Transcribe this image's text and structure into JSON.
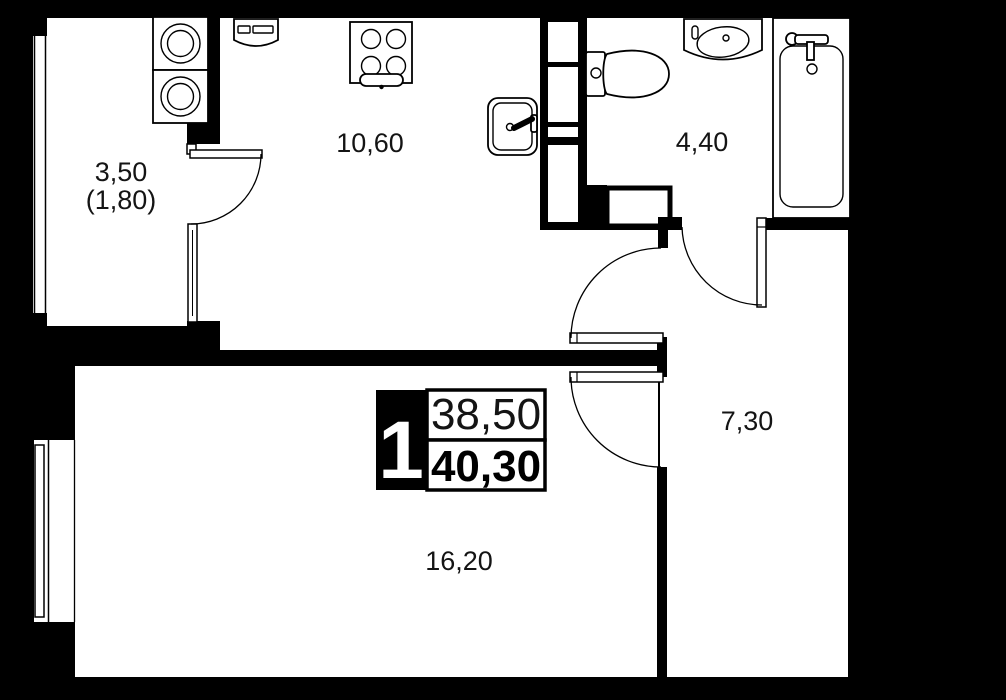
{
  "plan": {
    "unit_badge": {
      "rooms_count": "1",
      "living_area": "38,50",
      "total_area": "40,30"
    },
    "rooms": {
      "balcony": {
        "area": "3,50",
        "area_secondary": "(1,80)"
      },
      "kitchen": {
        "area": "10,60"
      },
      "bathroom": {
        "area": "4,40"
      },
      "hallway": {
        "area": "7,30"
      },
      "living": {
        "area": "16,20"
      }
    },
    "colors": {
      "background": "#000000",
      "floor": "#ffffff",
      "walls": "#000000",
      "label_text": "#141414"
    }
  }
}
